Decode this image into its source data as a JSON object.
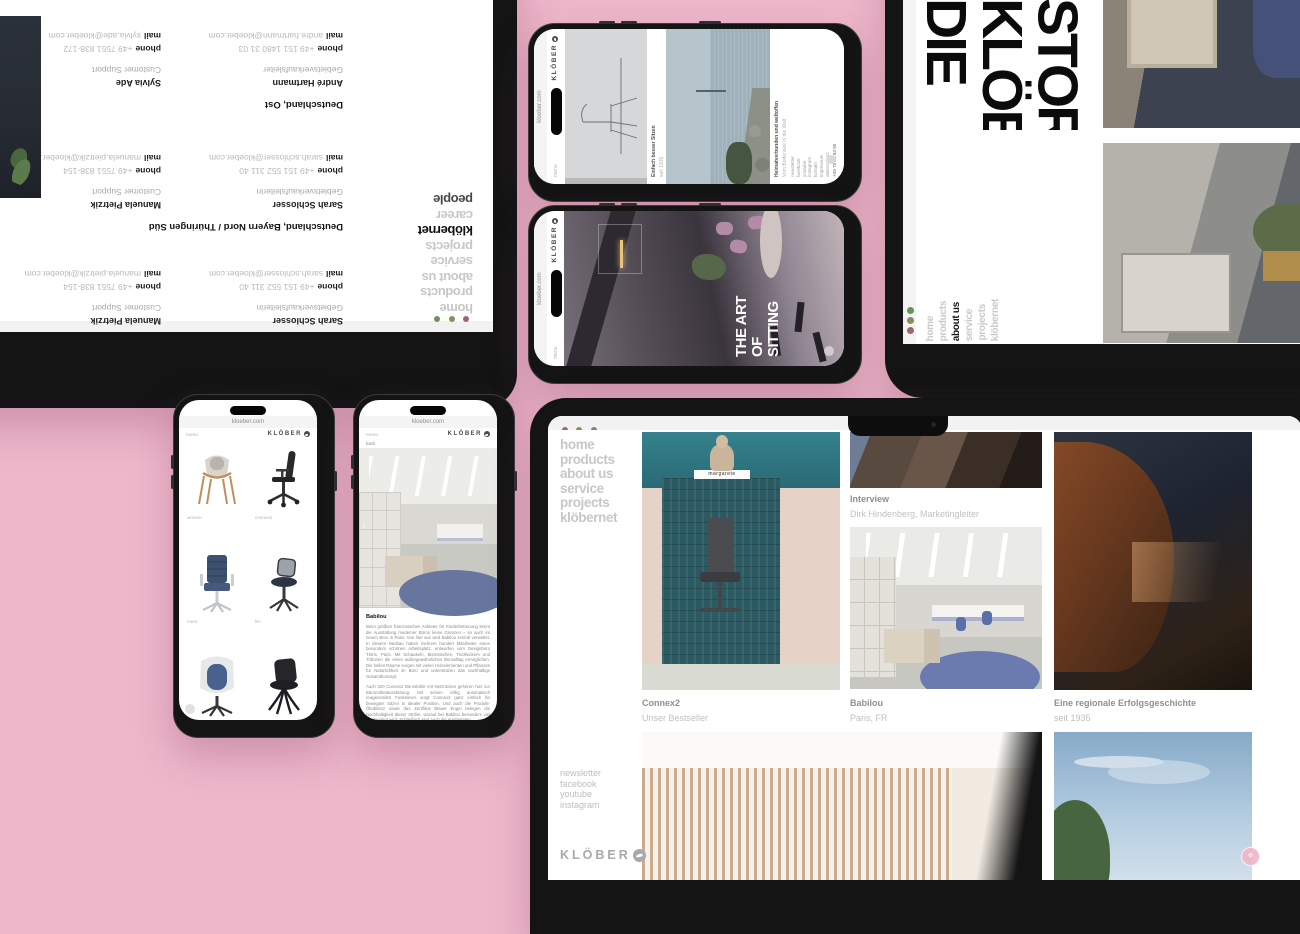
{
  "background_color": "#eeb7ca",
  "browser_url": "kloeber.com",
  "brand": {
    "name": "KLÖBER"
  },
  "labels": {
    "phone": "phone",
    "mail": "mail",
    "menu": "menu",
    "back": "back"
  },
  "colors": {
    "accent_pink": "#eeb7ca",
    "nav_gray": "#c7c7c7",
    "traffic_red": "#9a686c",
    "traffic_olive": "#8b8b5e",
    "traffic_green": "#69935f"
  },
  "main_nav": [
    {
      "label": "home"
    },
    {
      "label": "products"
    },
    {
      "label": "about us"
    },
    {
      "label": "service"
    },
    {
      "label": "projects"
    },
    {
      "label": "klöbernet"
    }
  ],
  "tablet_home": {
    "cards": [
      {
        "title": "Connex2",
        "subtitle": "Unser Bestseller",
        "image_label": "margarete"
      },
      {
        "title": "Interview",
        "subtitle": "Dirk Hindenberg, Marketingleiter"
      },
      {
        "title": "Babilou",
        "subtitle": "Paris, FR"
      },
      {
        "title": "Eine regionale Erfolgsgeschichte",
        "subtitle": "seit 1935"
      }
    ],
    "footer_links": [
      {
        "label": "newsletter"
      },
      {
        "label": "facebook"
      },
      {
        "label": "youtube"
      },
      {
        "label": "instagram"
      }
    ]
  },
  "laptop_people": {
    "nav": [
      {
        "label": "home"
      },
      {
        "label": "products"
      },
      {
        "label": "about us"
      },
      {
        "label": "service"
      },
      {
        "label": "projects"
      },
      {
        "label": "klöbernet",
        "cls": "active"
      },
      {
        "label": "career"
      },
      {
        "label": "people",
        "cls": "current"
      }
    ],
    "regions": {
      "bayern": "Deutschland, Bayern Nord / Thüringen Süd",
      "ost": "Deutschland, Ost"
    },
    "contacts": {
      "sarah": {
        "name": "Sarah Schlosser",
        "role": "Gebietsverkaufsleiterin",
        "phone": "+49 151 552 311 40",
        "mail": "sarah.schlosser@kloeber.com"
      },
      "manuela": {
        "name": "Manuela Pietrzik",
        "role": "Customer Support",
        "phone": "+49 7551 838-154",
        "mail": "manuela.pietrzik@kloeber.com"
      },
      "andre": {
        "name": "André Hartmann",
        "role": "Gebietsverkaufsleiter",
        "phone": "+49 151 1480 31 03",
        "mail": "andre.hartmann@kloeber.com"
      },
      "sylvia": {
        "name": "Sylvia Ade",
        "role": "Customer Support",
        "phone": "+49 7551 838-172",
        "mail": "sylvia.ade@kloeber.com"
      }
    }
  },
  "tablet_story": {
    "headline_words": [
      {
        "word": "DIE"
      },
      {
        "word": "KLÖBER"
      },
      {
        "word": "STORY"
      }
    ],
    "nav": [
      {
        "label": "home"
      },
      {
        "label": "products"
      },
      {
        "label": "about us",
        "cls": "active"
      },
      {
        "label": "service"
      },
      {
        "label": "projects"
      },
      {
        "label": "klöbernet"
      }
    ]
  },
  "phone_hero": {
    "headline_lines": [
      {
        "line": "THE ART"
      },
      {
        "line": "OF"
      },
      {
        "line": "SITTING"
      }
    ]
  },
  "phone_about": {
    "captions": [
      {
        "line1": "Einfach besser Sitzen",
        "line2": "seit 1935"
      },
      {
        "line1": "Heimatverbunden und weltoffen",
        "line2": "Vom Bodensee in die Welt"
      }
    ],
    "footer_links": [
      {
        "label": "newsletter"
      },
      {
        "label": "facebook"
      },
      {
        "label": "youtube"
      },
      {
        "label": "instagram"
      },
      {
        "label": "kontakt"
      },
      {
        "label": "impressum"
      },
      {
        "label": "datenschutz"
      }
    ],
    "footer_phone": "+49 75 51 83 80"
  },
  "phone_products": {
    "items": [
      {
        "label": "wooom"
      },
      {
        "label": "connex2"
      },
      {
        "label": "mera"
      },
      {
        "label": "lim"
      },
      {
        "label": ""
      },
      {
        "label": ""
      }
    ]
  },
  "phone_babilou": {
    "heading": "Babilou",
    "paragraphs": [
      {
        "text": "Beim größten französischen Anbieter für Kinderbetreuung kennt die Ausstattung moderner Büros keine Grenzen – so auch im neuen Büro in Paris. Von hier aus wird Babilou zentral verwaltet. In diesem Neubau haben mehrere hundert Mitarbeiter einen besonders schönen Arbeitsplatz, entworfen vom Designbüro Tétris, Paris. Mit Schaukeln, Bistrotischen, Tischkickern und Tribünen die einen außergewöhnlichen Büroalltag ermöglichen. Die hellen Räume sorgen mit vielen Holzelementen und Pflanzen für Natürlichkeit im Büro und unterstützen das nachhaltige Gesamtkonzept."
      },
      {
        "text": "Auch 320 Connex2 Bürostühle mit Netzrücken gehören hier zur Büromöbelausstattung. Mit seinen völlig automatisch reagierenden Funktionen sorgt Connex2 ganz einfach für bewegtes Sitzen in idealer Position. Und auch die Produkt-Ökobilanz sowie das Zertifikat Blauer Engel belegen die Nachhaltigkeit dieser Stühle, worauf bei Babilou besonders viel Wert gelegt wird. Schließlich sind auch die erarbeiteten"
      }
    ]
  }
}
